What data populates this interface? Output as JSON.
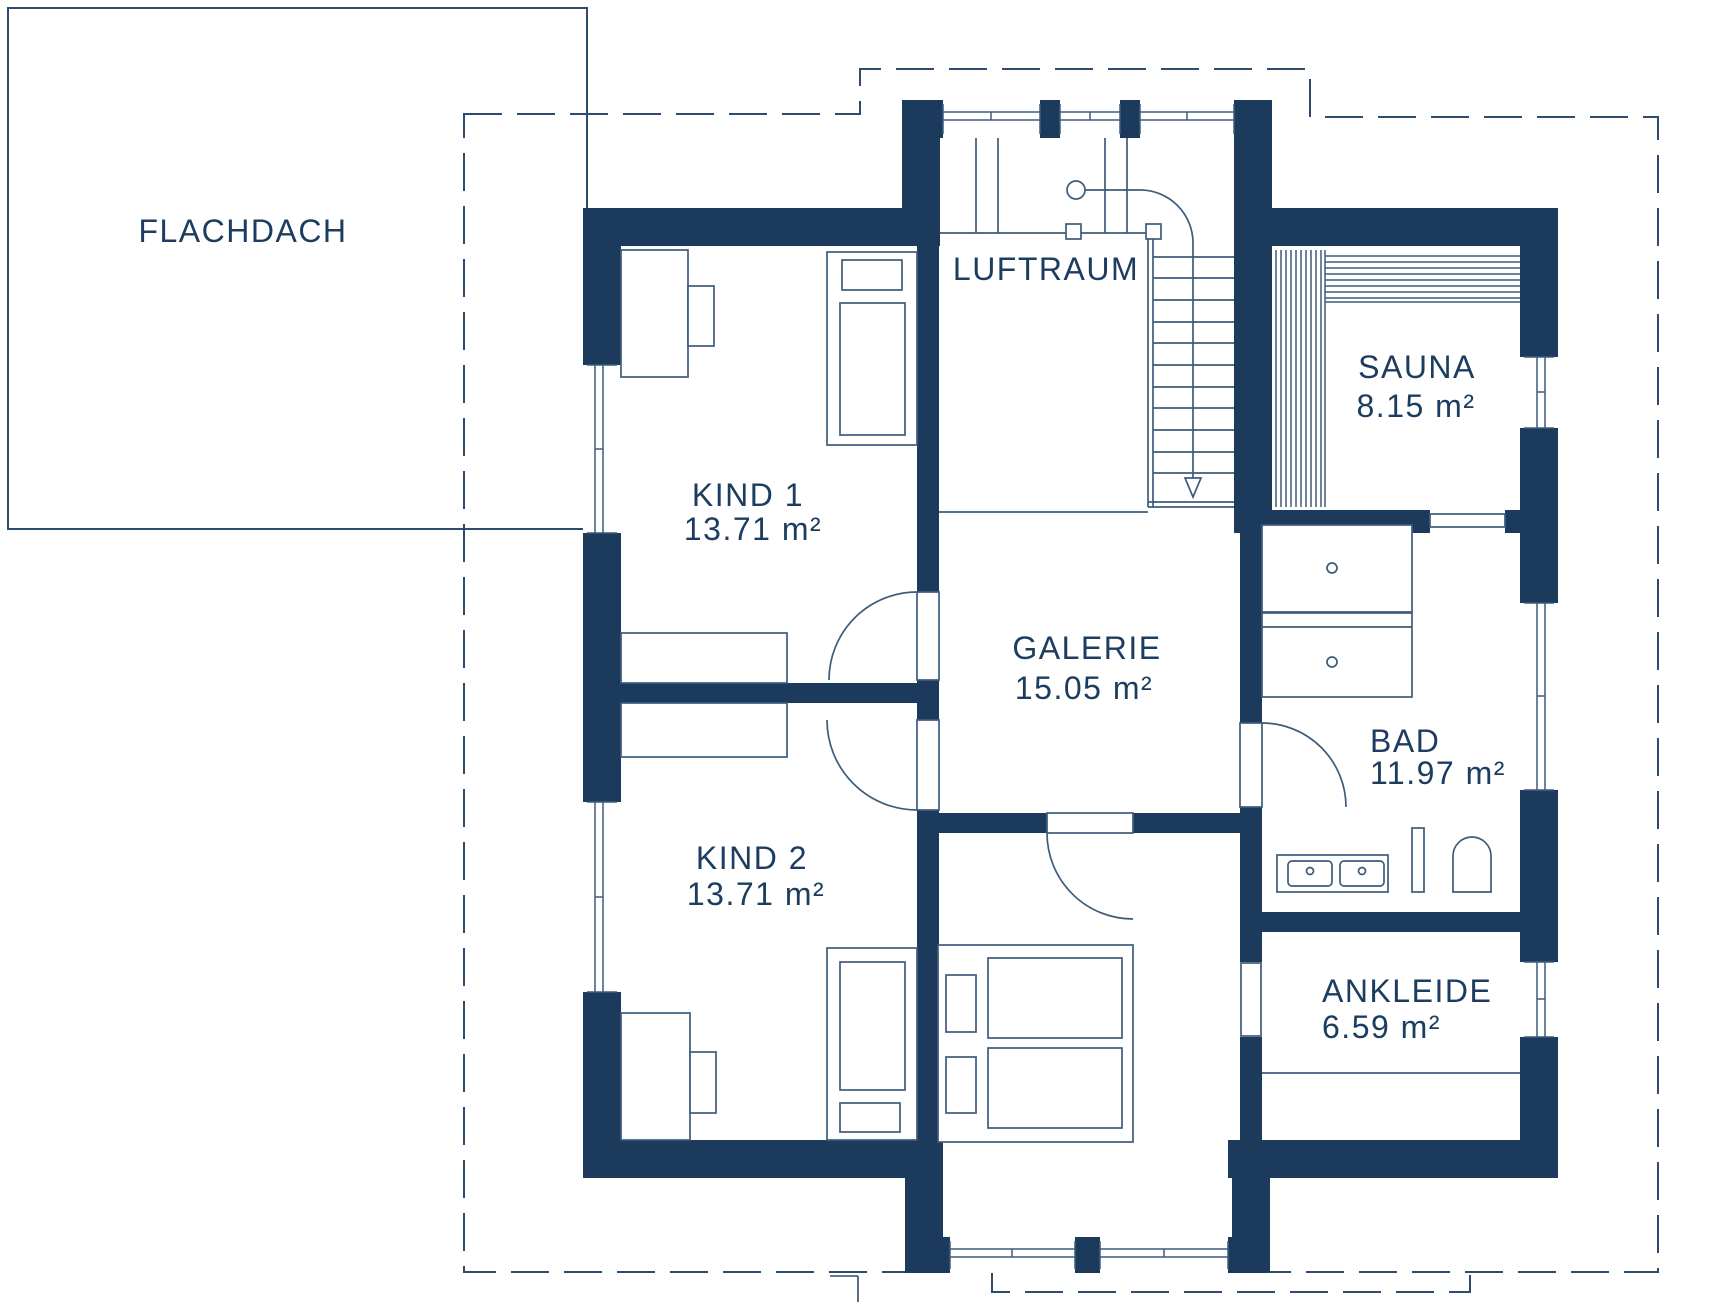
{
  "colors": {
    "wall": "#1b3a5c",
    "line": "#3d5c7c",
    "text": "#1d3d60",
    "background": "#ffffff"
  },
  "rooms": {
    "flachdach": {
      "name": "FLACHDACH"
    },
    "luftraum": {
      "name": "LUFTRAUM"
    },
    "kind1": {
      "name": "KIND 1",
      "area": "13.71 m²"
    },
    "kind2": {
      "name": "KIND 2",
      "area": "13.71 m²"
    },
    "galerie": {
      "name": "GALERIE",
      "area": "15.05 m²"
    },
    "sauna": {
      "name": "SAUNA",
      "area": "8.15 m²"
    },
    "bad": {
      "name": "BAD",
      "area": "11.97 m²"
    },
    "ankleide": {
      "name": "ANKLEIDE",
      "area": "6.59 m²"
    }
  }
}
